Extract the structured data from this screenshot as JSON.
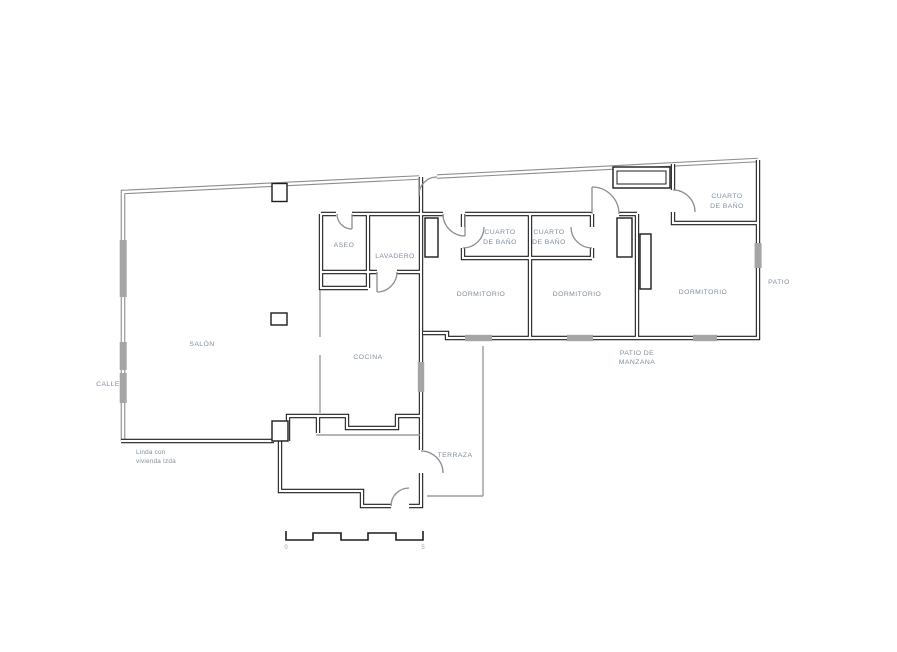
{
  "plan": {
    "labels": {
      "salon": "SALÓN",
      "cocina": "COCINA",
      "aseo": "ASEO",
      "lavadero": "LAVADERO",
      "dormitorio1": "DORMITORIO",
      "dormitorio2": "DORMITORIO",
      "dormitorio3": "DORMITORIO",
      "bano1_l1": "CUARTO",
      "bano1_l2": "DE BAÑO",
      "bano2_l1": "CUARTO",
      "bano2_l2": "DE BAÑO",
      "bano3_l1": "CUARTO",
      "bano3_l2": "DE BAÑO",
      "terraza": "TERRAZA",
      "patio": "PATIO",
      "patio_manzana_l1": "PATIO DE",
      "patio_manzana_l2": "MANZANA",
      "calle": "CALLE",
      "linda_l1": "Linda con",
      "linda_l2": "vivienda Izda",
      "scale_start": "0",
      "scale_end": "5"
    },
    "colors": {
      "wall": "#1d1d1d",
      "outer_wall": "#8d8d8d",
      "label": "#7f8e9d",
      "window": "#a5a5a5",
      "door": "#8d8d8d",
      "thin": "#9c9c9c",
      "scale_num": "#98a2ac"
    }
  }
}
